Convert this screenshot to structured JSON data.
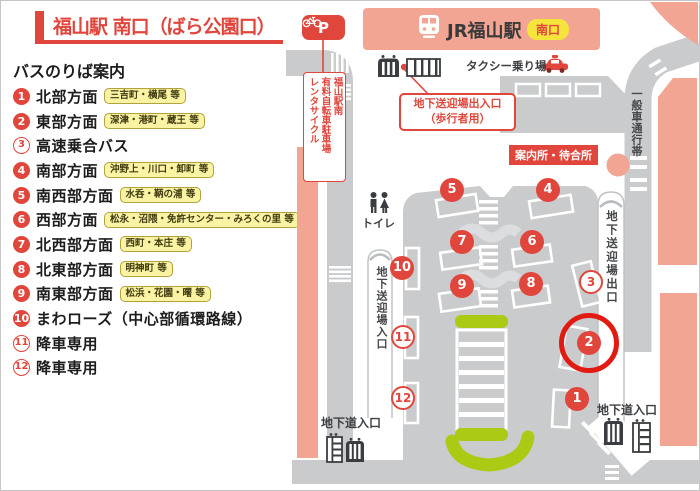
{
  "colors": {
    "accent_red": "#E0463C",
    "highlight_ring": "#E21B12",
    "building_salmon": "#F3A593",
    "road_gray": "#C9CBCD",
    "lawn_green": "#A9CB13",
    "badge_yellow": "#F6E33C",
    "tag_yellow": "#FAF3A4"
  },
  "legend": {
    "title": "福山駅 南口（ばら公園口）",
    "subtitle": "バスのりば案内",
    "items": [
      {
        "no": "1",
        "style": "filled",
        "label": "北部方面",
        "tag": "三吉町・横尾 等"
      },
      {
        "no": "2",
        "style": "filled",
        "label": "東部方面",
        "tag": "深津・港町・蔵王 等"
      },
      {
        "no": "3",
        "style": "outline",
        "label": "高速乗合バス",
        "tag": ""
      },
      {
        "no": "4",
        "style": "filled",
        "label": "南部方面",
        "tag": "沖野上・川口・卸町 等"
      },
      {
        "no": "5",
        "style": "filled",
        "label": "南西部方面",
        "tag": "水呑・鞆の浦 等"
      },
      {
        "no": "6",
        "style": "filled",
        "label": "西部方面",
        "tag": "松永・沼隈・免許センター・みろくの里 等"
      },
      {
        "no": "7",
        "style": "filled",
        "label": "北西部方面",
        "tag": "西町・本庄 等"
      },
      {
        "no": "8",
        "style": "filled",
        "label": "北東部方面",
        "tag": "明神町 等"
      },
      {
        "no": "9",
        "style": "filled",
        "label": "南東部方面",
        "tag": "松浜・花園・曙 等"
      },
      {
        "no": "10",
        "style": "filled",
        "label": "まわローズ（中心部循環路線）",
        "tag": ""
      },
      {
        "no": "11",
        "style": "outline",
        "label": "降車専用",
        "tag": ""
      },
      {
        "no": "12",
        "style": "outline",
        "label": "降車専用",
        "tag": ""
      }
    ]
  },
  "map": {
    "station": {
      "name": "JR福山駅",
      "badge": "南口"
    },
    "labels": {
      "taxi": "タクシー乗り場",
      "info": "案内所・待合所",
      "underpass_gate": "地下送迎場出入口",
      "underpass_gate2": "（歩行者用）",
      "ramp_exit": "地下送迎場出口",
      "ramp_entrance": "地下送迎場入口",
      "general_lane": "一般車通行帯",
      "toilet": "トイレ",
      "underground_left": "地下道入口",
      "underground_right": "地下道入口",
      "parking_p": "P",
      "parking_lines": [
        "福山駅南",
        "有料自転車駐車場",
        "レンタサイクル"
      ]
    },
    "stops": [
      {
        "no": "1",
        "style": "filled",
        "x": 577,
        "y": 399
      },
      {
        "no": "2",
        "style": "filled",
        "x": 589,
        "y": 343,
        "highlight": true
      },
      {
        "no": "3",
        "style": "outline",
        "x": 591,
        "y": 282
      },
      {
        "no": "4",
        "style": "filled",
        "x": 548,
        "y": 190
      },
      {
        "no": "5",
        "style": "filled",
        "x": 452,
        "y": 190
      },
      {
        "no": "6",
        "style": "filled",
        "x": 532,
        "y": 242
      },
      {
        "no": "7",
        "style": "filled",
        "x": 462,
        "y": 242
      },
      {
        "no": "8",
        "style": "filled",
        "x": 531,
        "y": 284
      },
      {
        "no": "9",
        "style": "filled",
        "x": 462,
        "y": 286
      },
      {
        "no": "10",
        "style": "filled",
        "x": 402,
        "y": 268
      },
      {
        "no": "11",
        "style": "outline",
        "x": 403,
        "y": 337
      },
      {
        "no": "12",
        "style": "outline",
        "x": 403,
        "y": 398
      }
    ]
  }
}
